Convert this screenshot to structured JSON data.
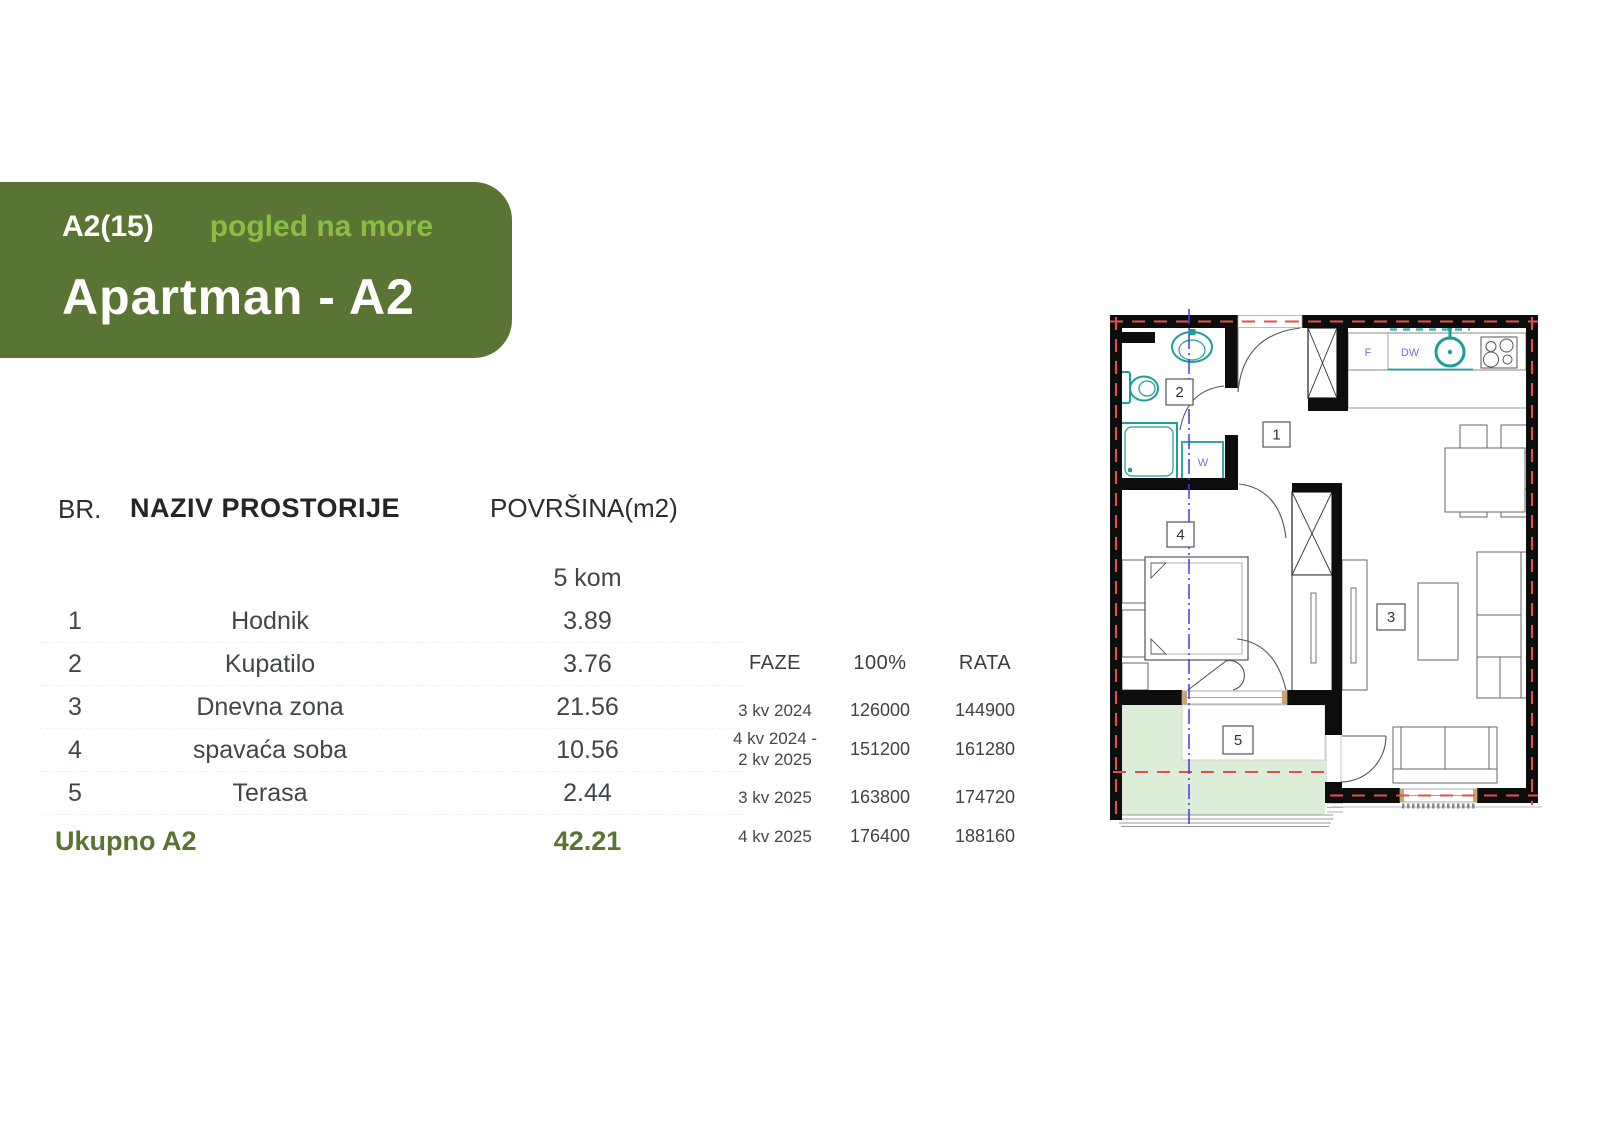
{
  "banner": {
    "code": "A2(15)",
    "view_label": "pogled na more",
    "title": "Apartman - A2",
    "bg_color": "#5a7533",
    "accent_color": "#8cbc45"
  },
  "rooms_table": {
    "headers": {
      "number": "BR.",
      "name": "NAZIV PROSTORIJE",
      "area": "POVRŠINA(m2)"
    },
    "subheader": "5 kom",
    "rows": [
      {
        "number": "1",
        "name": "Hodnik",
        "area": "3.89"
      },
      {
        "number": "2",
        "name": "Kupatilo",
        "area": "3.76"
      },
      {
        "number": "3",
        "name": "Dnevna zona",
        "area": "21.56"
      },
      {
        "number": "4",
        "name": "spavaća soba",
        "area": "10.56"
      },
      {
        "number": "5",
        "name": "Terasa",
        "area": "2.44"
      }
    ],
    "total": {
      "label": "Ukupno A2",
      "area": "42.21"
    }
  },
  "phases_table": {
    "headers": {
      "phase": "FAZE",
      "full": "100%",
      "installment": "RATA"
    },
    "rows": [
      {
        "phase": "3 kv 2024",
        "phase2": "",
        "full": "126000",
        "installment": "144900"
      },
      {
        "phase": "4 kv 2024 -",
        "phase2": "2 kv 2025",
        "full": "151200",
        "installment": "161280"
      },
      {
        "phase": "3 kv 2025",
        "phase2": "",
        "full": "163800",
        "installment": "174720"
      },
      {
        "phase": "4 kv 2025",
        "phase2": "",
        "full": "176400",
        "installment": "188160"
      }
    ]
  },
  "floor_plan": {
    "labels": {
      "hallway": "1",
      "bathroom": "2",
      "living": "3",
      "bedroom": "4",
      "terrace": "5"
    },
    "appliances": {
      "fridge": "F",
      "dishwasher": "DW",
      "washer": "W"
    },
    "colors": {
      "wall": "#0d0d0d",
      "fixture": "#1d9e99",
      "terrace_fill": "#dcedd8",
      "axis_line": "#3c3cec",
      "boundary_line": "#e25048",
      "appliance_text": "#7070e8"
    }
  }
}
